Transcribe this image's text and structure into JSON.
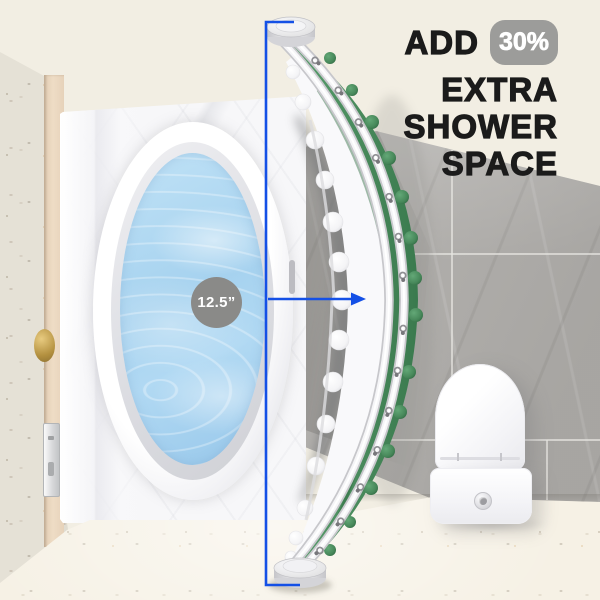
{
  "headline": {
    "add": "ADD",
    "badge_percent": "30%",
    "line_extra": "EXTRA",
    "line_shower": "SHOWER",
    "line_space": "SPACE"
  },
  "measurement": {
    "rod_offset_label": "12.5”"
  },
  "colors": {
    "annotation_blue": "#1450e6",
    "percent_badge_gray": "#9c9c9a",
    "measurement_circle_gray": "#8a8a88",
    "curtain_green": "#47885a",
    "water_blue": "#a9d4f1",
    "marble_gray": "#b7b5b2",
    "headline_black": "#1b1b1b"
  }
}
